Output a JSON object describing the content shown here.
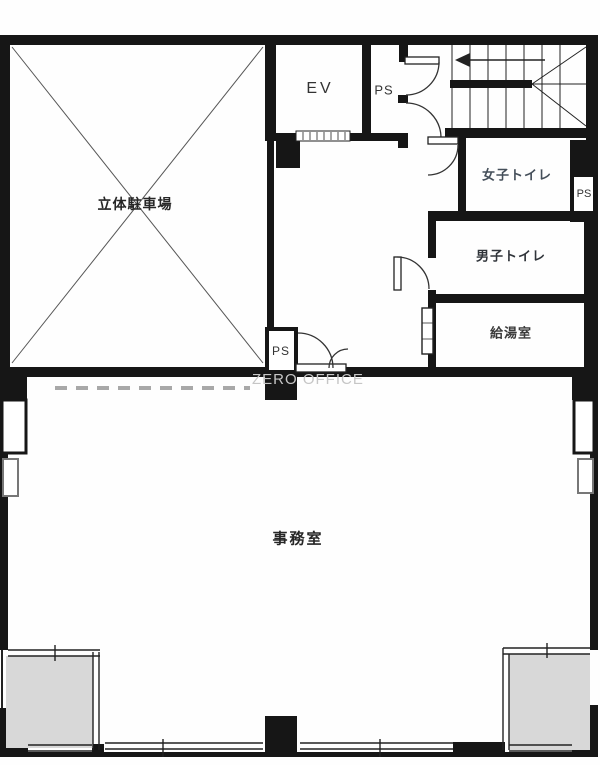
{
  "floorplan": {
    "watermark": "ZERO OFFICE",
    "labels": {
      "parking": "立体駐車場",
      "elevator": "EV",
      "pipe_space_top": "PS",
      "pipe_space_hall": "PS",
      "pipe_space_right": "PS",
      "womens_toilet": "女子トイレ",
      "mens_toilet": "男子トイレ",
      "kitchenette": "給湯室",
      "office": "事務室"
    },
    "colors": {
      "wall": "#161616",
      "line": "#2a2a2a",
      "balcony_fill": "#d8d8d8",
      "watermark": "#c6c6c6"
    }
  }
}
